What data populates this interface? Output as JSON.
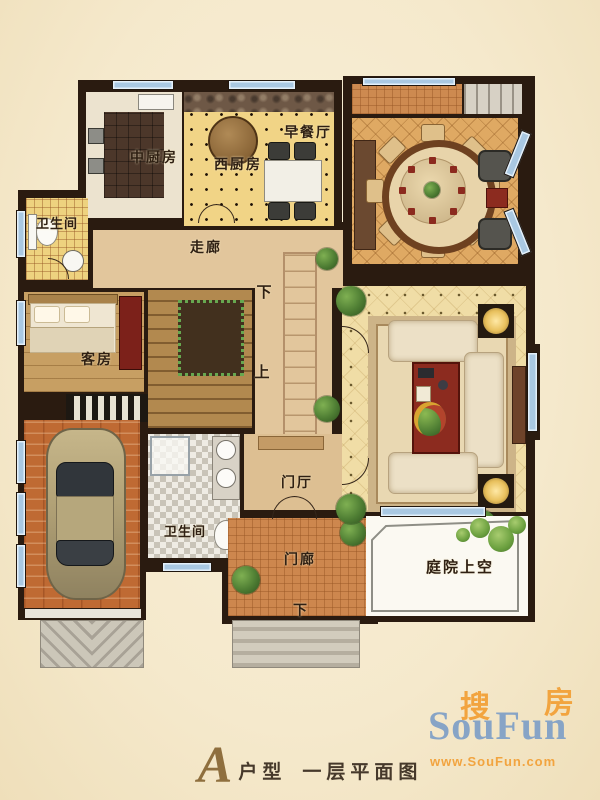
{
  "plan": {
    "rooms": {
      "kitchen_cn": "中厨房",
      "kitchen_west": "西厨房",
      "breakfast": "早餐厅",
      "bath_top": "卫生间",
      "corridor": "走廊",
      "stair_down": "下",
      "stair_up": "上",
      "guest_room": "客房",
      "bath_main": "卫生间",
      "foyer": "门厅",
      "porch": "门廊",
      "porch_step_down": "下",
      "courtyard": "庭院上空"
    },
    "caption": {
      "letter": "A",
      "type_suffix": "户型",
      "floor_name": "一层平面图"
    }
  },
  "logo": {
    "zh_left": "搜",
    "zh_right": "房",
    "name_en": "SouFun",
    "url": "www.SouFun.com"
  },
  "colors": {
    "wall": "#2a1b10",
    "paper": "#f6ecd2",
    "logo_blue": "#87a4c6",
    "logo_orange": "#f2a43f"
  }
}
